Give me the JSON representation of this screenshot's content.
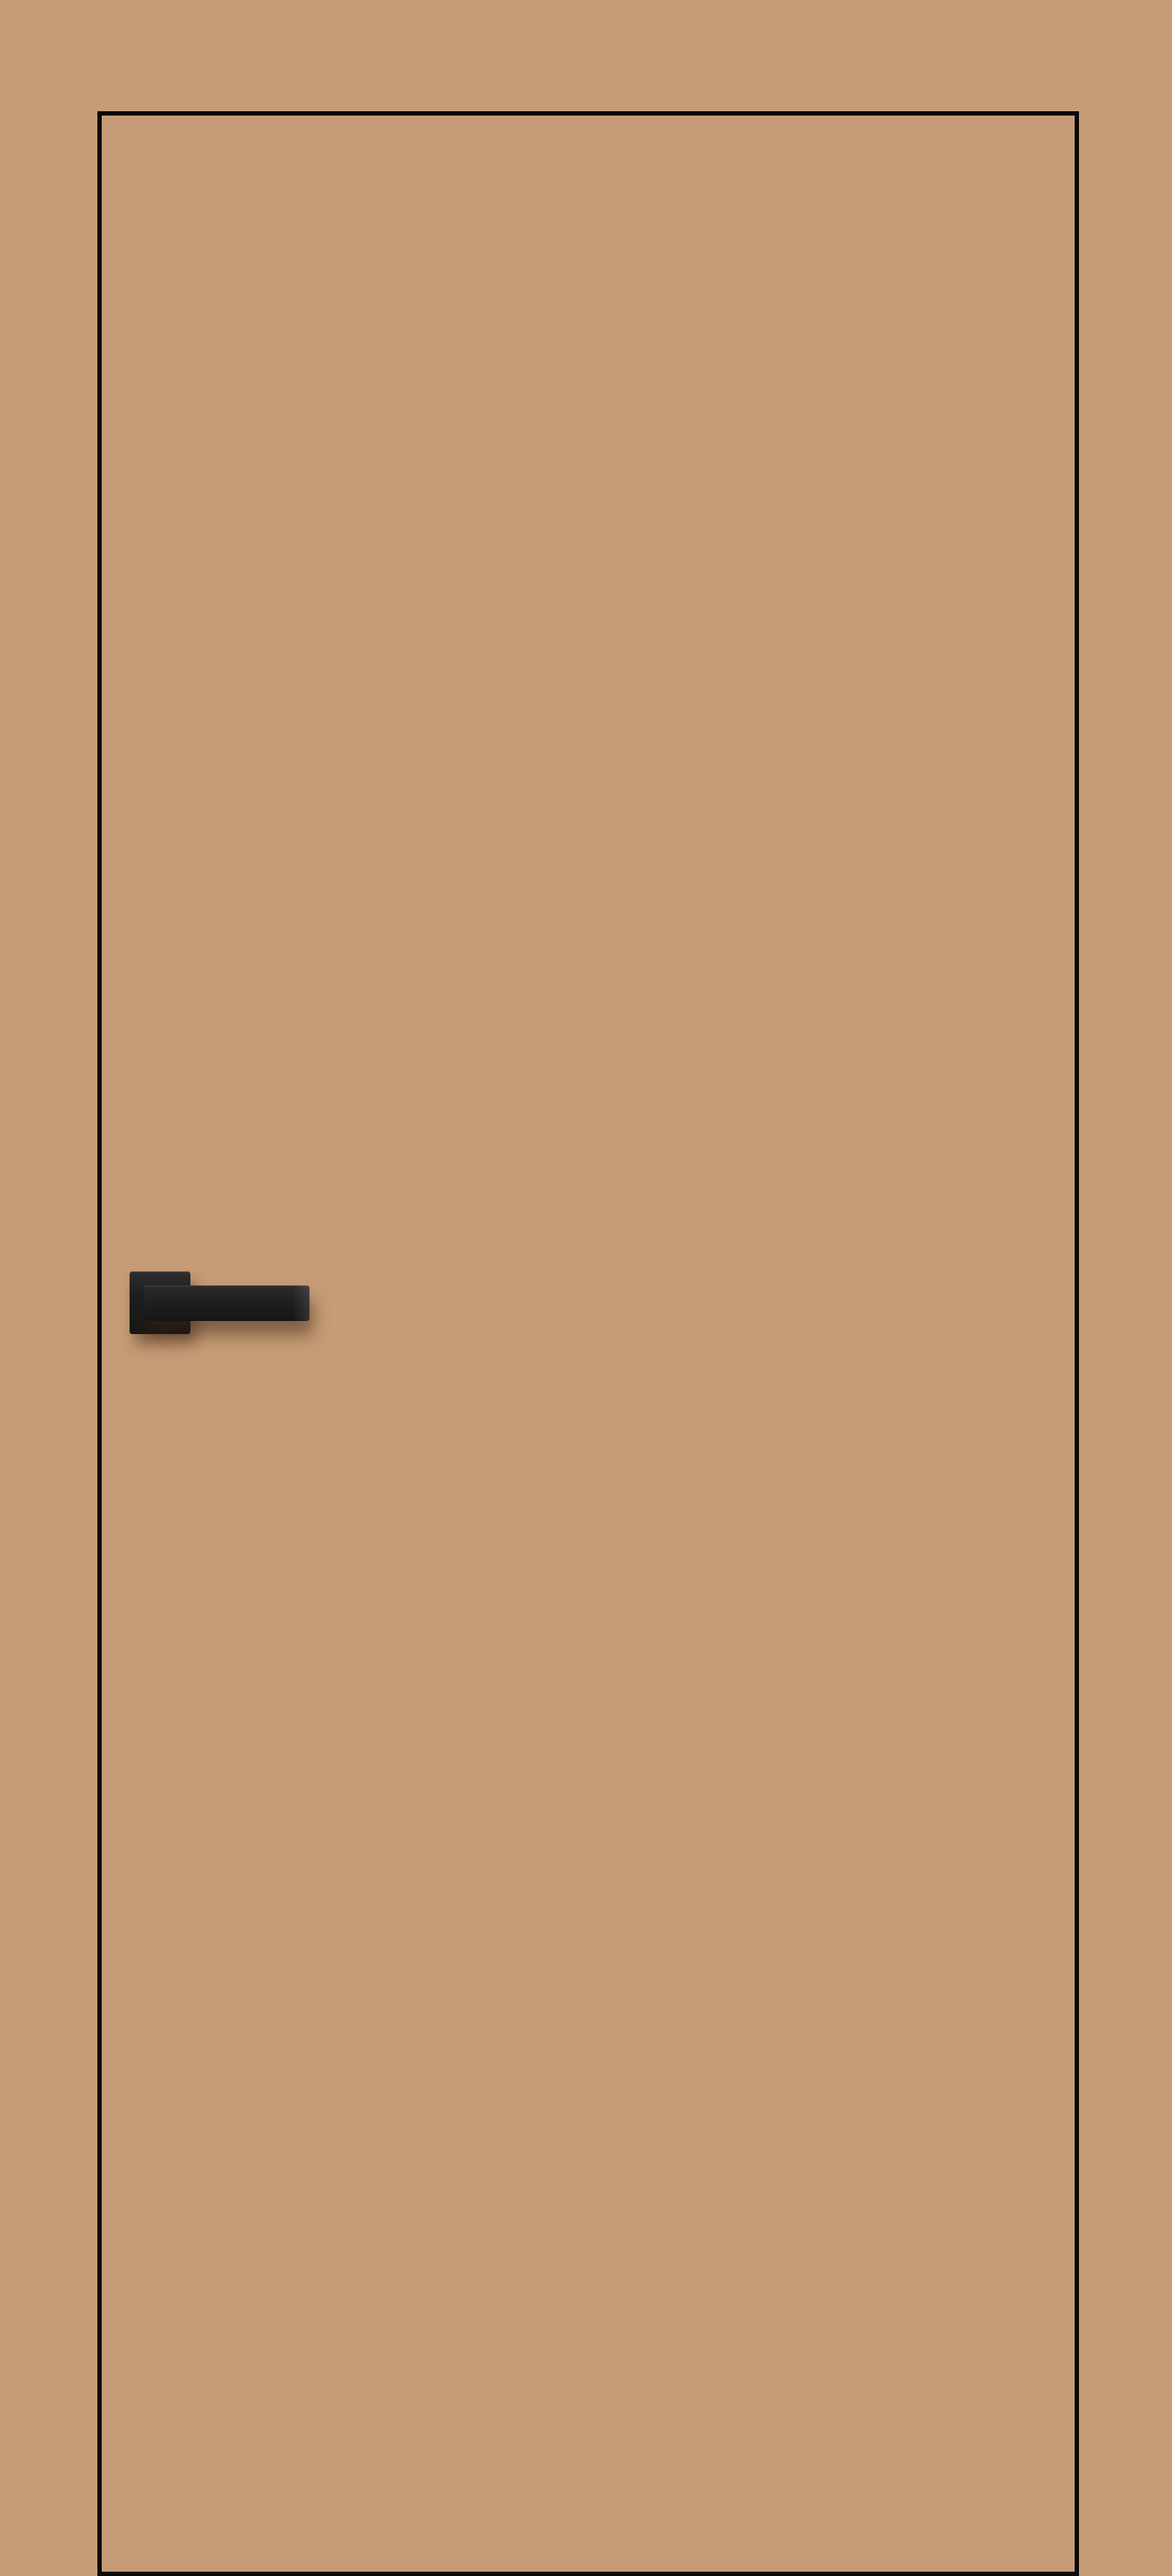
{
  "scene": {
    "label": "Tan interior flush door with black edge outline and matte black square-rosette lever handle on the left side"
  },
  "colors": {
    "wall": "#c69c76",
    "door-face": "#c69c76",
    "door-outline": "#0b0b0b",
    "handle-dark": "#161616",
    "handle-mid": "#1f1f1f",
    "handle-light": "#2d2d2d"
  }
}
